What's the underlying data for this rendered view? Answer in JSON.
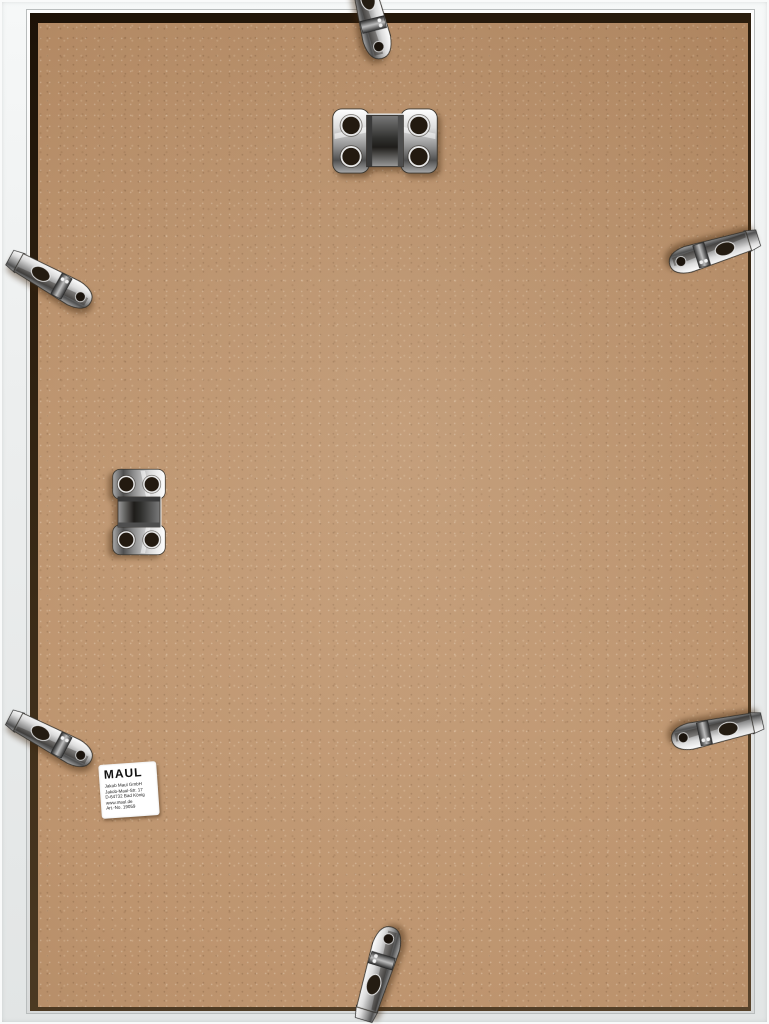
{
  "image": {
    "description": "Back side of a white aluminium picture frame with tan MDF backing board, six chrome spring clips and two chrome four-hole hanger brackets",
    "colors": {
      "frame_white": "#eef0f0",
      "frame_shadow": "#2b1d0e",
      "backing_tan": "#b98e67",
      "chrome_light": "#f4f4f4",
      "chrome_dark": "#3c3c3c",
      "label_bg": "#ffffff",
      "label_text": "#1a1a1a"
    },
    "hardware": {
      "spring_clips": [
        "top-center",
        "upper-left",
        "upper-right",
        "lower-left",
        "lower-right",
        "bottom-center"
      ],
      "hanger_brackets": [
        "top-center-horizontal",
        "middle-left-vertical"
      ]
    },
    "label": {
      "brand": "MAUL",
      "lines": [
        "Jakob Maul GmbH",
        "Jakob-Maul-Str. 17",
        "D-64732 Bad König",
        "www.maul.de",
        "Art.-No. 19059"
      ]
    }
  }
}
